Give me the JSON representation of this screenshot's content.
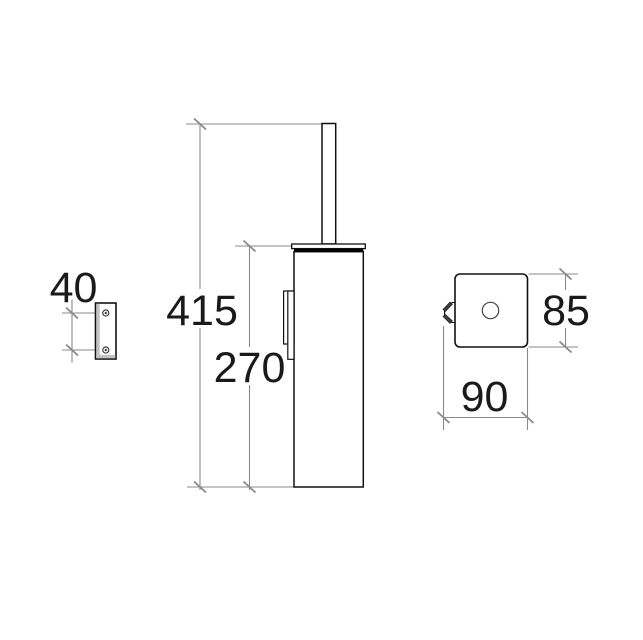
{
  "drawing": {
    "background": "#ffffff",
    "line_colors": {
      "object": "#111111",
      "dimension": "#8a8a8a"
    },
    "text_color": "#1a1a1a",
    "views": {
      "mount_plate_side": {
        "labels": {
          "hole_spacing_mm": "40"
        }
      },
      "holder_front": {
        "labels": {
          "overall_height_mm": "415",
          "body_height_mm": "270"
        }
      },
      "holder_top": {
        "labels": {
          "depth_mm": "85",
          "width_mm": "90"
        }
      }
    }
  }
}
